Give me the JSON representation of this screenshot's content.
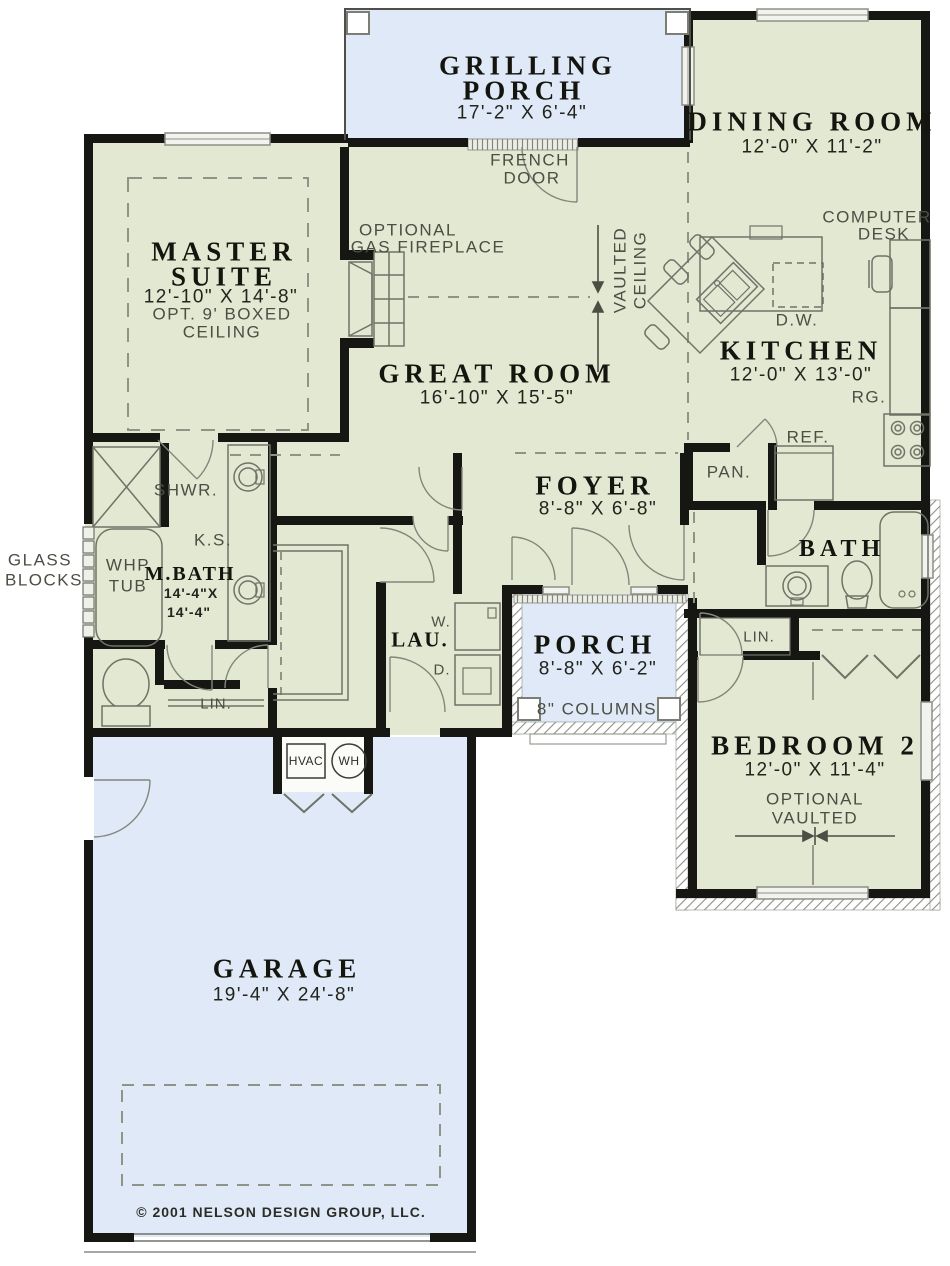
{
  "colors": {
    "room_green": "#e3e8d2",
    "porch_blue": "#dfe9f7",
    "wall_black": "#161613",
    "fixture_line": "#6f7368",
    "label_dark": "#15150f",
    "label_gray": "#4c4e44"
  },
  "rooms": {
    "grilling_porch": {
      "l1": "GRILLING",
      "l2": "PORCH",
      "dims": "17'-2\" X 6'-4\""
    },
    "dining": {
      "name": "DINING ROOM",
      "dims": "12'-0\" X 11'-2\""
    },
    "master": {
      "l1": "MASTER",
      "l2": "SUITE",
      "dims": "12'-10\" X 14'-8\"",
      "note1": "OPT. 9' BOXED",
      "note2": "CEILING"
    },
    "great": {
      "name": "GREAT ROOM",
      "dims": "16'-10\" X 15'-5\""
    },
    "kitchen": {
      "name": "KITCHEN",
      "dims": "12'-0\" X 13'-0\""
    },
    "foyer": {
      "name": "FOYER",
      "dims": "8'-8\" X 6'-8\""
    },
    "bath": {
      "name": "BATH"
    },
    "mbath": {
      "name": "M.BATH",
      "d1": "14'-4\"X",
      "d2": "14'-4\""
    },
    "laundry": {
      "name": "LAU."
    },
    "porch": {
      "name": "PORCH",
      "dims": "8'-8\" X 6'-2\"",
      "columns": "8\" COLUMNS"
    },
    "bedroom2": {
      "name": "BEDROOM 2",
      "dims": "12'-0\" X 11'-4\"",
      "note1": "OPTIONAL",
      "note2": "VAULTED"
    },
    "garage": {
      "name": "GARAGE",
      "dims": "19'-4\" X 24'-8\""
    }
  },
  "ann": {
    "french1": "FRENCH",
    "french2": "DOOR",
    "fp1": "OPTIONAL",
    "fp2": "GAS FIREPLACE",
    "vault1": "VAULTED",
    "vault2": "CEILING",
    "desk1": "COMPUTER",
    "desk2": "DESK",
    "glass1": "GLASS",
    "glass2": "BLOCKS",
    "whp1": "WHP",
    "whp2": "TUB",
    "shwr": "SHWR.",
    "ks": "K.S.",
    "lin_master": "LIN.",
    "lin_bath": "LIN.",
    "washer": "W.",
    "dryer": "D.",
    "hvac": "HVAC",
    "wh": "WH",
    "dw": "D.W.",
    "rg": "RG.",
    "ref": "REF.",
    "pan": "PAN."
  },
  "footer": {
    "copyright": "© 2001 NELSON DESIGN GROUP, LLC."
  }
}
